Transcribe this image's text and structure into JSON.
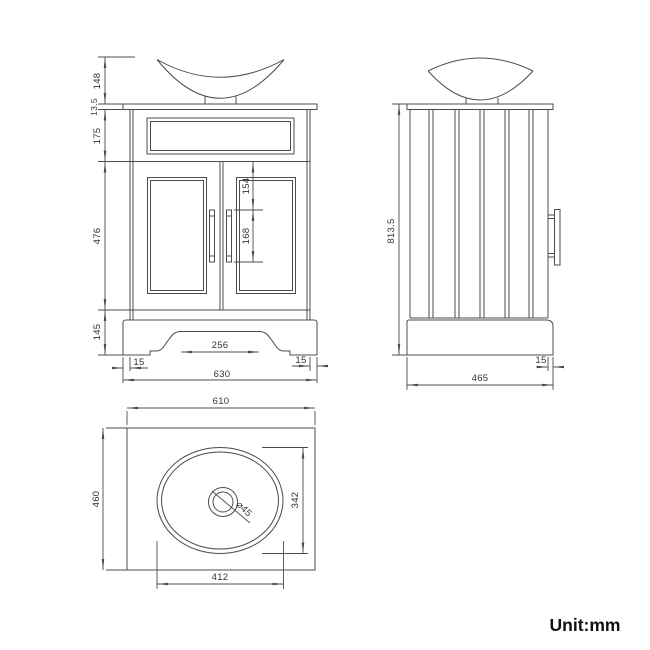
{
  "unit_label": "Unit:mm",
  "colors": {
    "line": "#4c4c4c",
    "dimension_text": "#333333",
    "background": "#ffffff"
  },
  "views": {
    "front": {
      "dims": {
        "basin_height": "148",
        "countertop_thickness": "13.5",
        "drawer_section_height": "175",
        "door_section_height": "476",
        "plinth_height": "145",
        "handle_offset_top": "154",
        "handle_length": "168",
        "plinth_cutout_width": "256",
        "side_inset_left": "15",
        "side_inset_right": "15",
        "overall_width": "630"
      }
    },
    "side": {
      "dims": {
        "overall_height": "813.5",
        "overall_depth": "465",
        "front_overhang": "15"
      }
    },
    "plan": {
      "dims": {
        "countertop_width": "610",
        "countertop_depth": "460",
        "basin_width": "342",
        "basin_length": "412",
        "drain_diameter": "⌀45"
      }
    }
  }
}
